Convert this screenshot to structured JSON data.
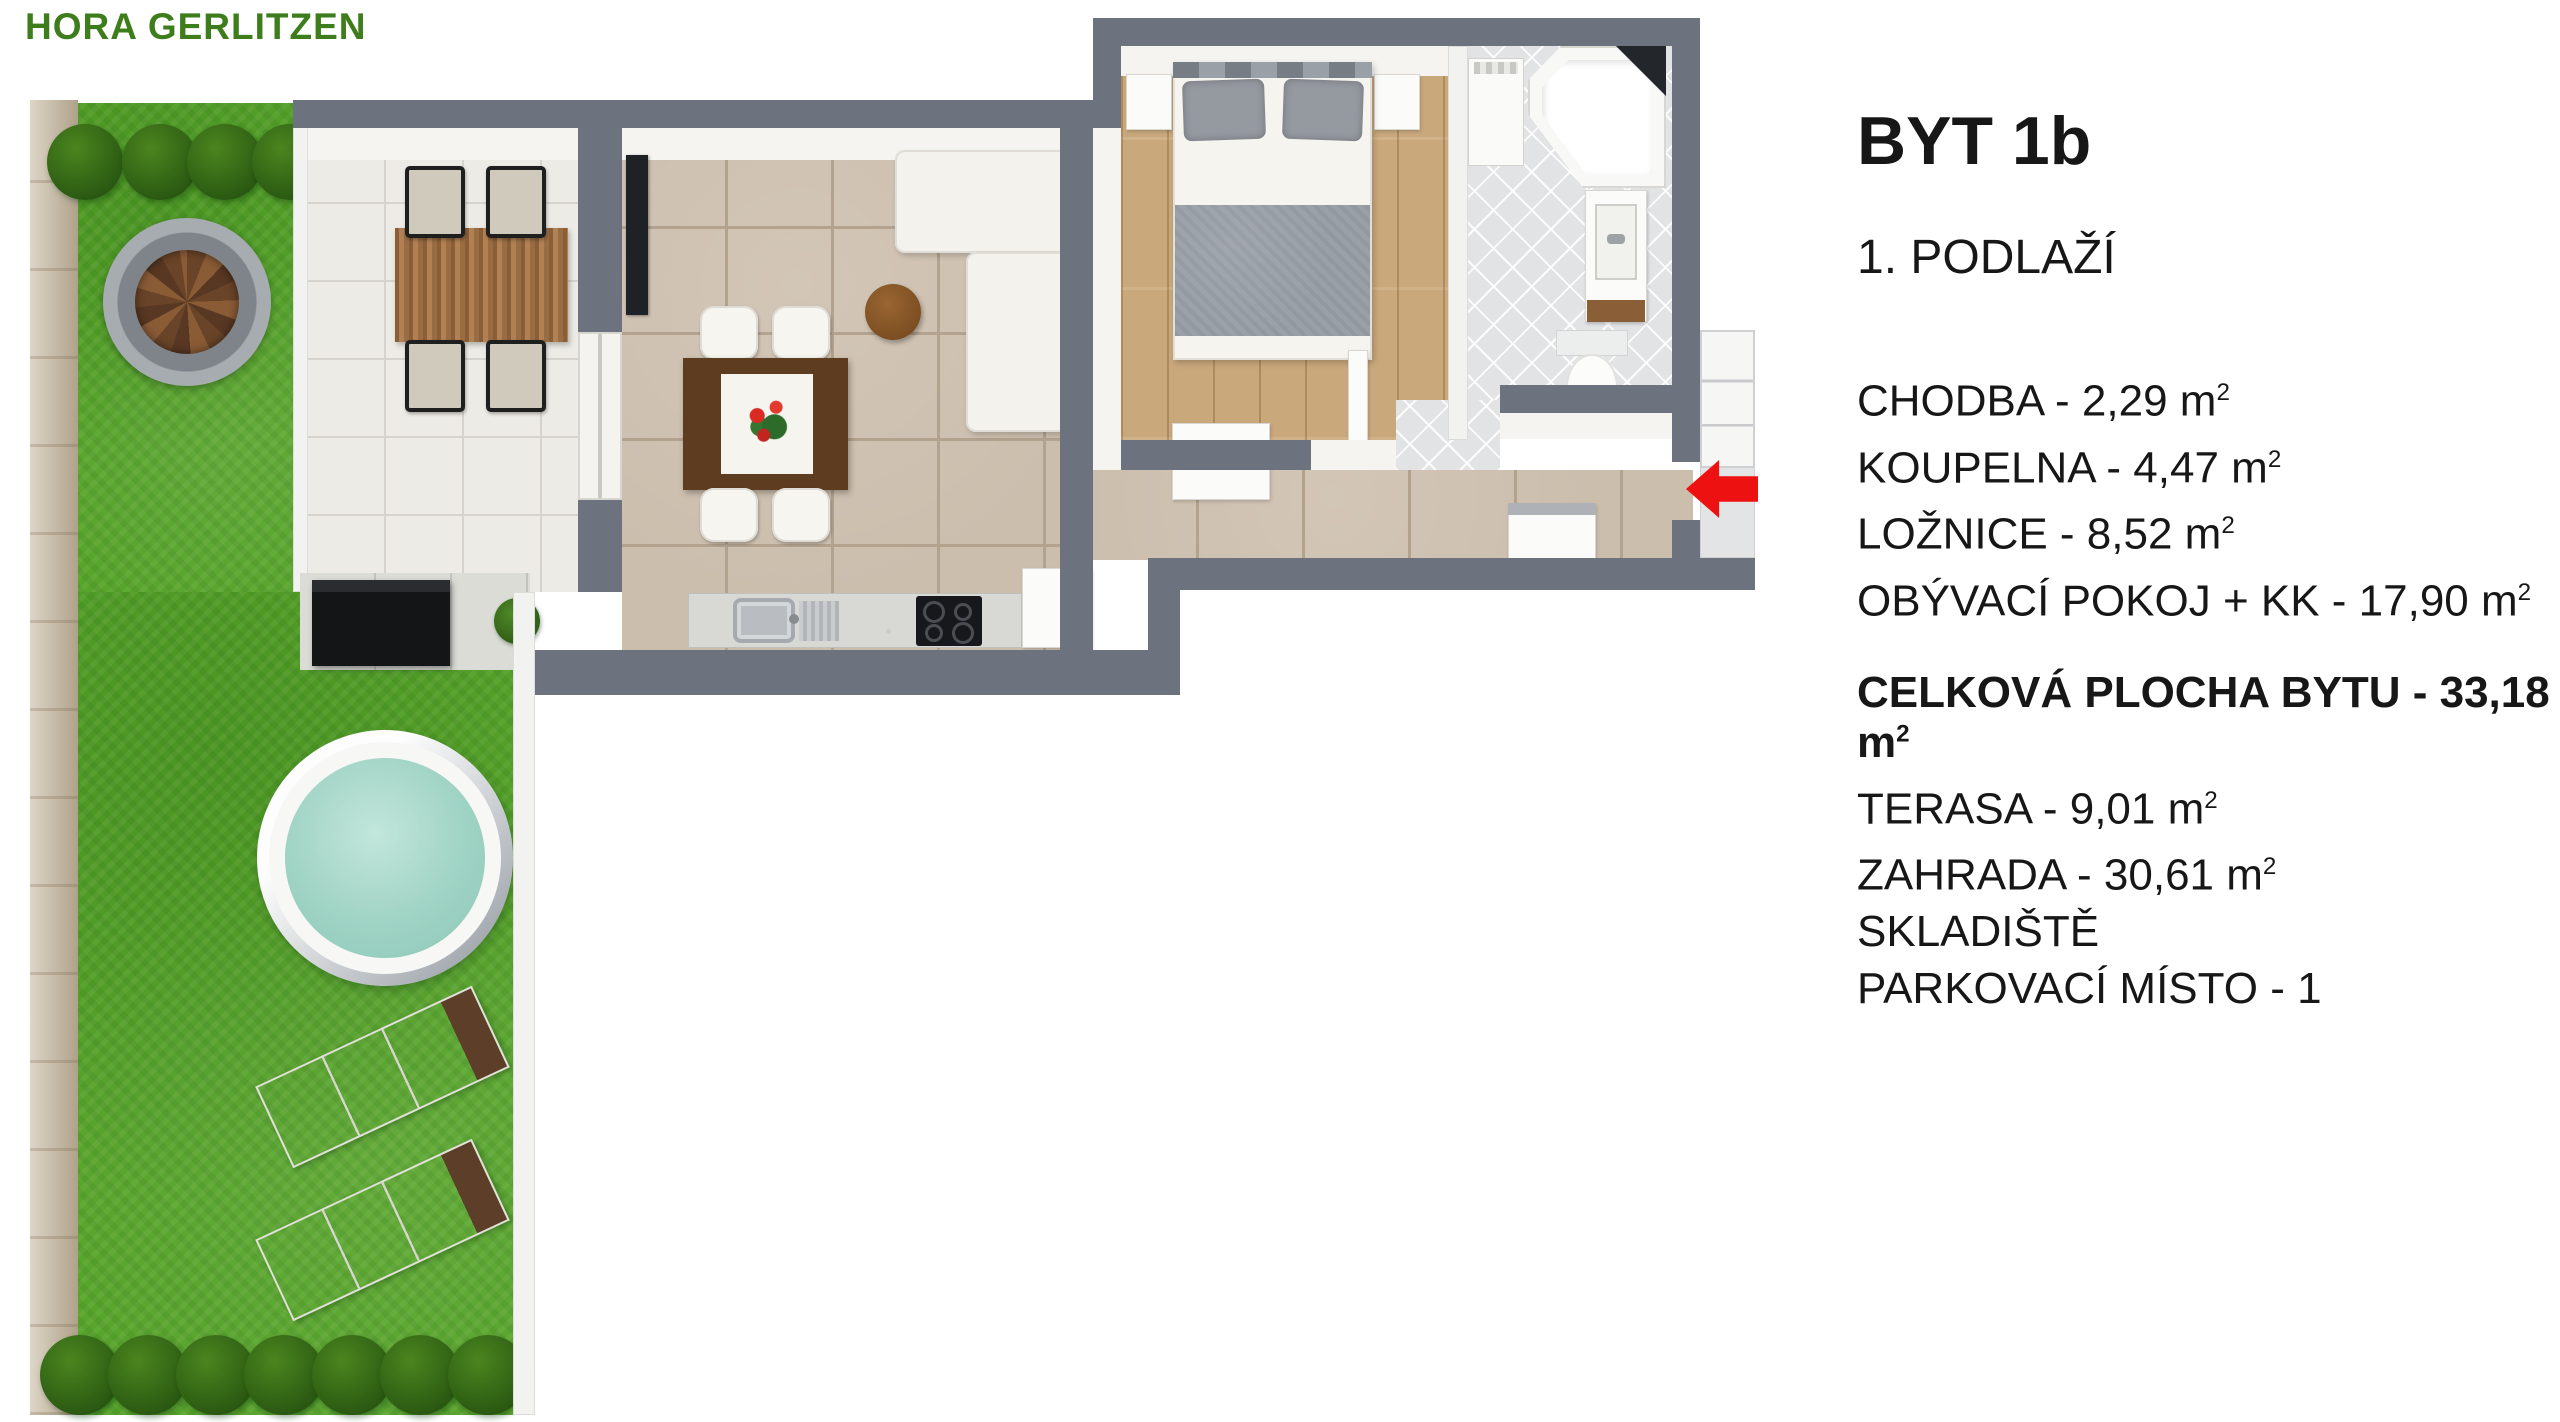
{
  "title": {
    "text": "HORA GERLITZEN"
  },
  "panel": {
    "apartment": "BYT 1b",
    "floor": "1. PODLAŽÍ",
    "rooms": [
      {
        "label": "CHODBA",
        "value": "2,29",
        "unit": "m2"
      },
      {
        "label": "KOUPELNA",
        "value": "4,47",
        "unit": "m2"
      },
      {
        "label": "LOŽNICE",
        "value": "8,52",
        "unit": "m2"
      },
      {
        "label": "OBÝVACÍ POKOJ + KK",
        "value": "17,90",
        "unit": "m2"
      }
    ],
    "total": {
      "label": "CELKOVÁ PLOCHA BYTU",
      "value": "33,18",
      "unit": "m2"
    },
    "outdoor": [
      {
        "label": "TERASA",
        "value": "9,01",
        "unit": "m2"
      },
      {
        "label": "ZAHRADA",
        "value": "30,61",
        "unit": "m2"
      },
      {
        "label": "SKLADIŠTĚ"
      },
      {
        "label": "PARKOVACÍ MÍSTO",
        "value": "1"
      }
    ]
  },
  "colors": {
    "title_green": "#3e7d1b",
    "wall_gray": "#6c737e",
    "grass_green": "#57a42c",
    "pool_water": "#9fd3c4",
    "entrance_arrow_red": "#ee1111",
    "wood_floor": "#c9a87c",
    "living_tile": "#ccbead",
    "terrace_tile": "#edebe5"
  }
}
